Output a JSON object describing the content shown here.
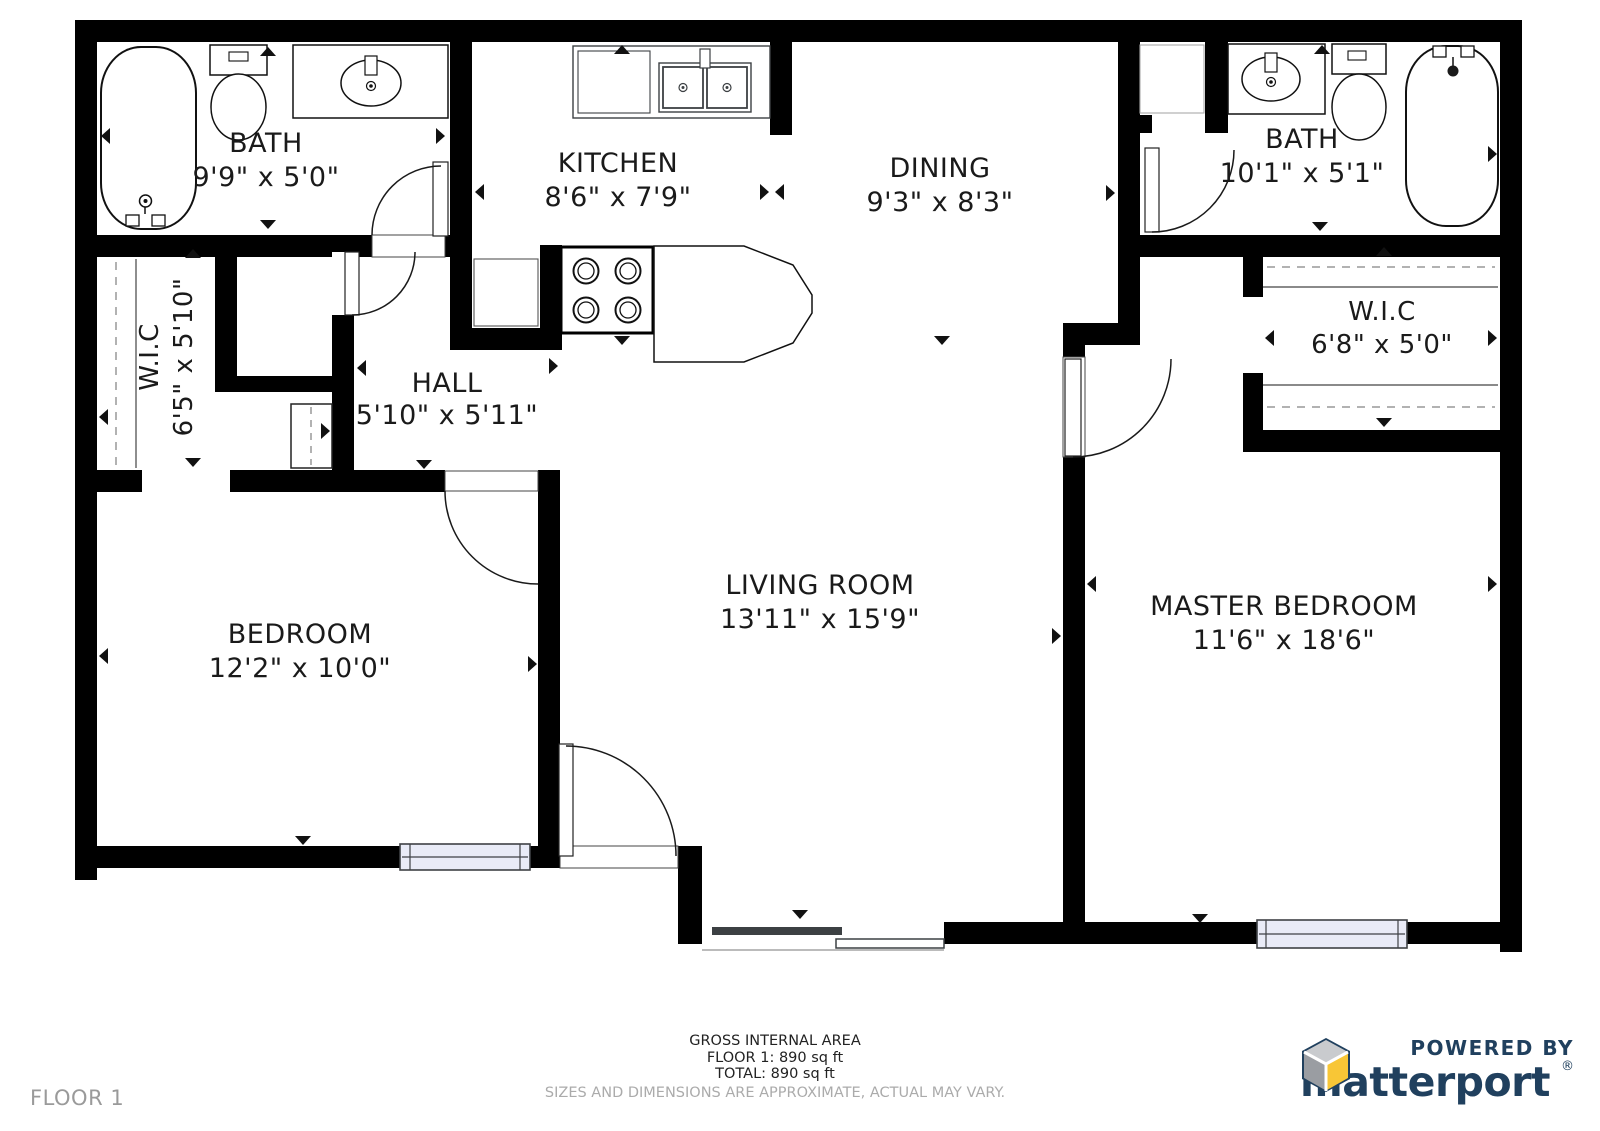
{
  "rooms": {
    "bath1": {
      "label": "BATH",
      "dims": "9'9\" x 5'0\""
    },
    "kitchen": {
      "label": "KITCHEN",
      "dims": "8'6\" x 7'9\""
    },
    "dining": {
      "label": "DINING",
      "dims": "9'3\" x 8'3\""
    },
    "bath2": {
      "label": "BATH",
      "dims": "10'1\" x 5'1\""
    },
    "wic_left": {
      "label": "W.I.C",
      "dims": "6'5\" x 5'10\""
    },
    "hall": {
      "label": "HALL",
      "dims": "5'10\" x 5'11\""
    },
    "wic_right": {
      "label": "W.I.C",
      "dims": "6'8\" x 5'0\""
    },
    "bedroom": {
      "label": "BEDROOM",
      "dims": "12'2\" x 10'0\""
    },
    "living_room": {
      "label": "LIVING ROOM",
      "dims": "13'11\" x 15'9\""
    },
    "master_bedroom": {
      "label": "MASTER BEDROOM",
      "dims": "11'6\" x 18'6\""
    }
  },
  "footer": {
    "area_title": "GROSS INTERNAL AREA",
    "floor_area": "FLOOR 1: 890 sq ft",
    "total_area": "TOTAL: 890 sq ft",
    "disclaimer": "SIZES AND DIMENSIONS ARE APPROXIMATE, ACTUAL MAY VARY.",
    "floor_label": "FLOOR 1"
  },
  "branding": {
    "powered_by": "POWERED BY",
    "brand_name": "matterport",
    "registered_mark": "®"
  },
  "colors": {
    "wall": "#000000",
    "window_fill": "#e9ebf7",
    "brand_navy": "#20405e",
    "brand_yellow": "#f8c636",
    "brand_gray": "#9a9da2",
    "muted": "#ababab"
  }
}
